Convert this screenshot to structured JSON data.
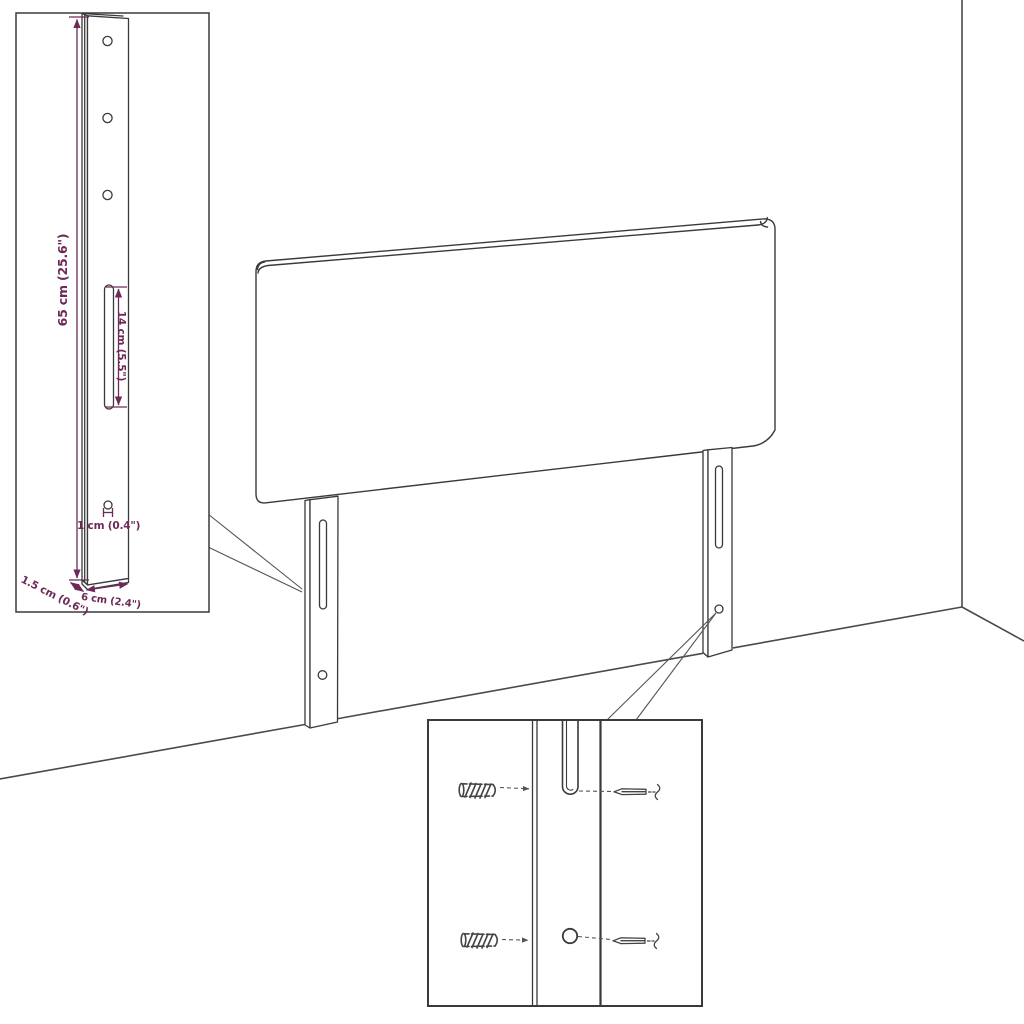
{
  "diagram": {
    "kind": "product-dimension-diagram",
    "colors": {
      "line": "#3a3a3a",
      "room_line": "#4a4a4a",
      "dimension": "#6d2a58",
      "background": "#ffffff"
    },
    "bracket_inset": {
      "dimensions": {
        "total_height": "65 cm (25.6\")",
        "slot_length": "14 cm (5.5\")",
        "hole_diameter": "1 cm (0.4\")",
        "thickness": "1.5 cm (0.6\")",
        "width": "6 cm (2.4\")"
      },
      "features": [
        "mounting-hole-icon",
        "mounting-hole-icon",
        "mounting-hole-icon",
        "keyhole-slot",
        "small-hole"
      ]
    },
    "mounting_inset": {
      "icons": [
        "wall-plug-icon",
        "screw-icon",
        "wall-plug-icon",
        "screw-icon"
      ],
      "features": [
        "keyhole-slot",
        "round-hole"
      ]
    },
    "scene": {
      "product": "headboard-with-two-legs",
      "environment": "room-corner-outline"
    }
  }
}
